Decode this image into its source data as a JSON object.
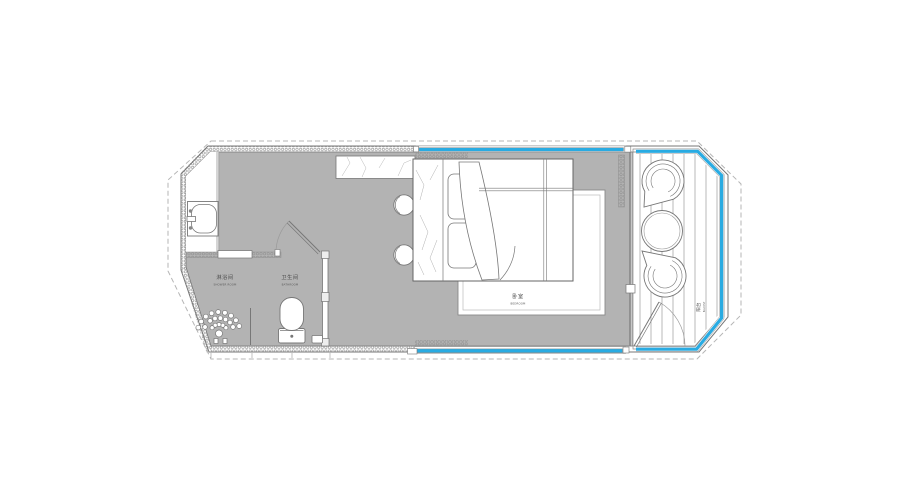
{
  "plan": {
    "rooms": {
      "shower_room": {
        "zh": "淋浴间",
        "en": "SHOWER ROOM"
      },
      "bathroom": {
        "zh": "卫生间",
        "en": "BATHROOM"
      },
      "bedroom": {
        "zh": "卧室",
        "en": "BEDROOM"
      },
      "balcony": {
        "zh": "阳台",
        "en": "BALCONY"
      }
    },
    "colors": {
      "floor": "#b3b3b3",
      "accent_blue": "#29abe2",
      "wall_line": "#777777",
      "dash_line": "#b5b5b5"
    }
  }
}
